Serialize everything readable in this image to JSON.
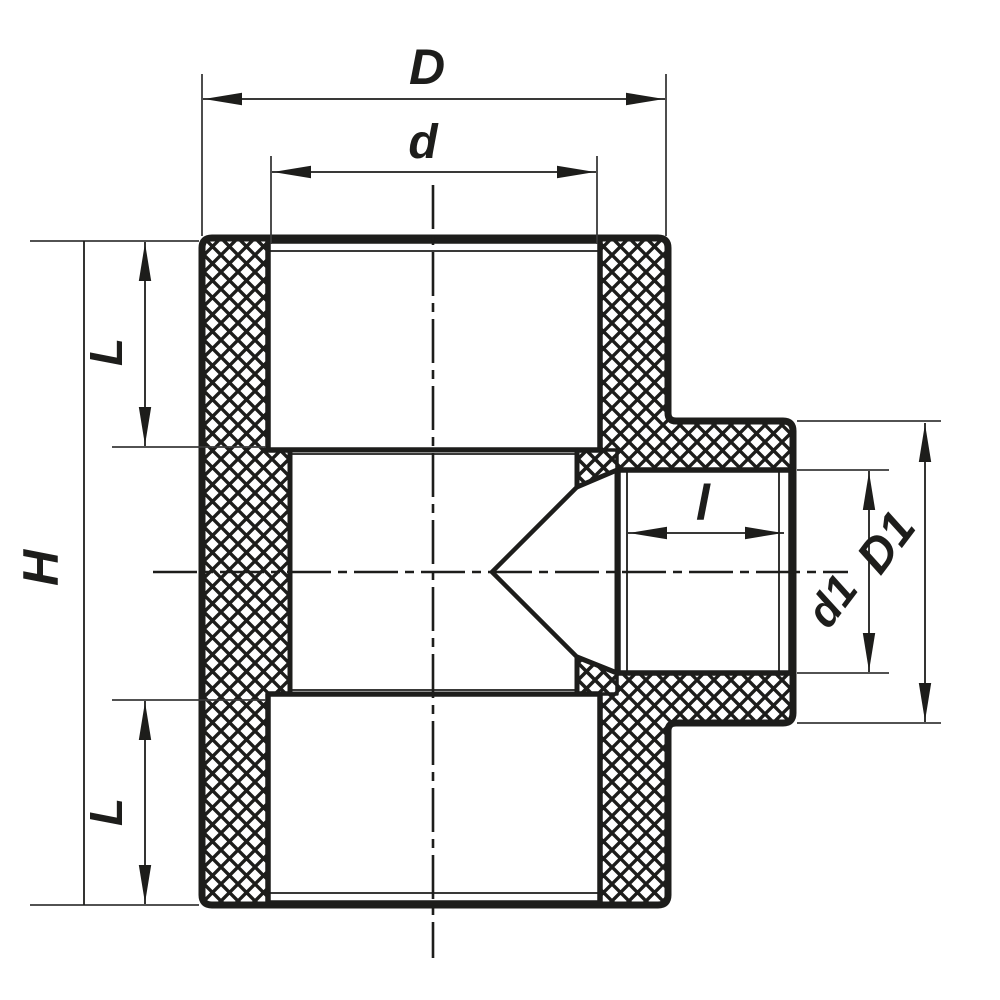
{
  "drawing": {
    "description": "Cross-section engineering drawing of a reducing tee pipe fitting with crosshatched section walls",
    "background_color": "#ffffff",
    "line_color": "#1d1d1b",
    "labels": {
      "D": "D",
      "d": "d",
      "L_top": "L",
      "H": "H",
      "L_bottom": "L",
      "l": "l",
      "d1": "d1",
      "D1": "D1"
    },
    "dimension_meanings": {
      "D": "overall body width (top run outer)",
      "d": "main socket inner diameter",
      "L_top": "top socket depth",
      "H": "overall body height",
      "L_bottom": "bottom socket depth",
      "l": "branch socket depth",
      "d1": "branch socket inner diameter",
      "D1": "branch outer diameter"
    }
  }
}
